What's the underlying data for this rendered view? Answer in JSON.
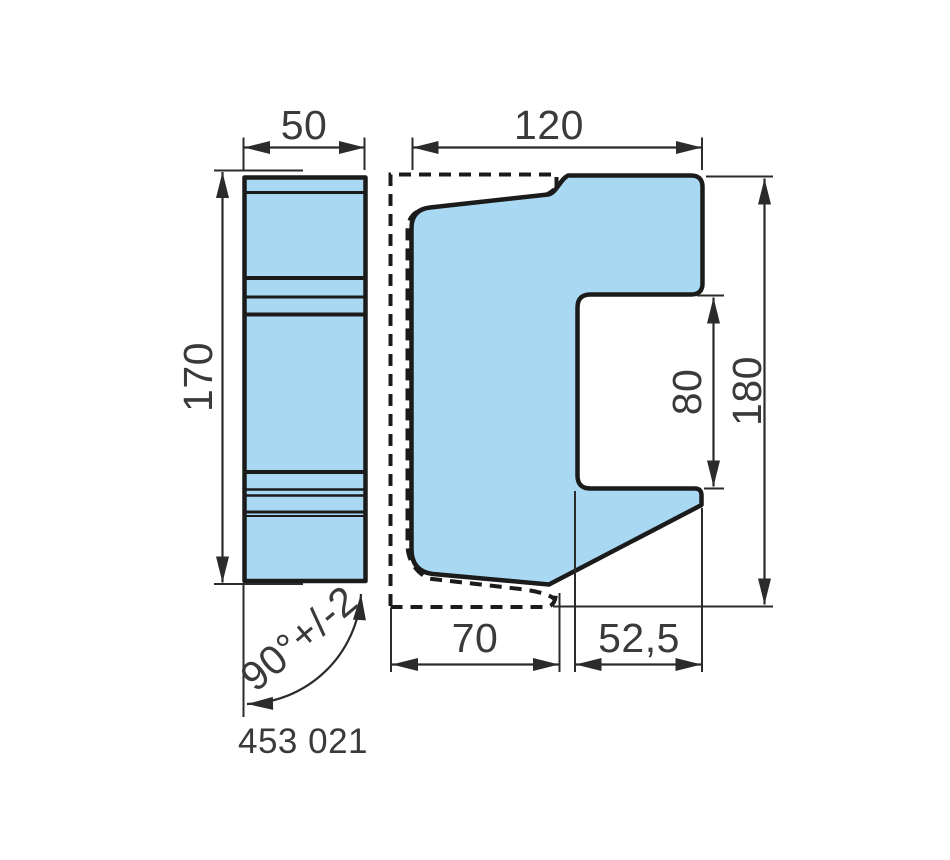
{
  "drawing": {
    "part_number": "453 021",
    "views": {
      "end_view": {
        "width_label": "50",
        "height_label": "170",
        "angle_label": "90°+/-2"
      },
      "profile_view": {
        "width_label": "120",
        "height_label": "180",
        "notch_label": "80",
        "base_label": "70",
        "offset_label": "52,5"
      }
    },
    "colors": {
      "part_fill": "#A9D9F2",
      "outline": "#1B1B1B",
      "dimension_line": "#2B2B2B",
      "text": "#3A3A3A",
      "background": "#FFFFFF"
    }
  }
}
